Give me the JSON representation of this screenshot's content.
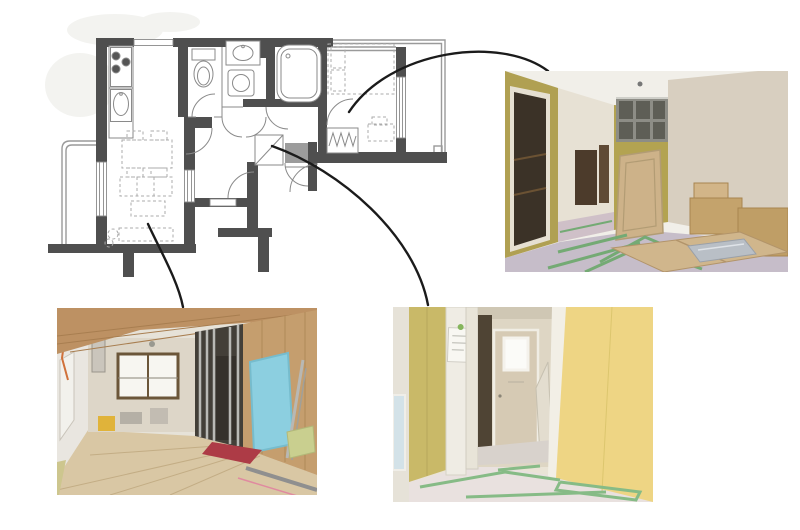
{
  "canvas": {
    "width": 800,
    "height": 530,
    "background": "#ffffff"
  },
  "composite": {
    "description": "apartment floor plan linked by curved arrows to three renovation site photos"
  },
  "floor_plan": {
    "colors": {
      "wall": "#4f4f4f",
      "fixture": "#8a8a8a",
      "furniture": "#ababab",
      "genkan": "#9c9c9c",
      "balcony": "#9a9a9a",
      "watermark": "#f3f3f0",
      "burner": "#555555"
    },
    "rooms": [
      "living-dining",
      "kitchen",
      "toilet",
      "washroom",
      "bathroom",
      "bedroom",
      "hallway",
      "entrance",
      "walk-in-closet",
      "balcony-left",
      "balcony-right"
    ],
    "fixtures": [
      "gas-stove",
      "kitchen-sink",
      "toilet-bowl",
      "washbasin",
      "washing-machine",
      "bathtub",
      "double-bed",
      "desk",
      "hanger-pipe-closet",
      "dining-table",
      "sofa",
      "coffee-table",
      "tv-board",
      "shoe-cabinet"
    ]
  },
  "connectors": {
    "color": "#1b1b1b",
    "width": 2.4,
    "items": [
      {
        "name": "bedroom-to-photo-top-right"
      },
      {
        "name": "living-to-photo-bottom-left"
      },
      {
        "name": "hallway-to-photo-bottom-center"
      }
    ]
  },
  "photos": [
    {
      "name": "photo-top-right",
      "depicts": "room under renovation with yellow plasterboard walls, cardboard boxes and green-taped floor protection",
      "palette": {
        "ceiling": "#f1efe9",
        "left_wall": "#b0a052",
        "door_frame": "#e6e0d2",
        "door_interior": "#3b3227",
        "corridor_wall": "#e7e1d4",
        "corridor_floor": "#cfc0c8",
        "grid_frame": "#8d8d86",
        "grid_cell": "#5e5e56",
        "center_wall": "#b3a351",
        "right_wall": "#d8cfc0",
        "panel": "#cdb289",
        "box": "#c4a36c",
        "box_light": "#d2b588",
        "box_dark": "#bf9e66",
        "box_top": "#d0b68c",
        "floor": "#c6bdc9",
        "tape": "#74aa74",
        "booklet": "#b9bfc6"
      }
    },
    {
      "name": "photo-bottom-left",
      "depicts": "living-dining room under renovation with plywood subfloor, metal stud partition and blue foam panel",
      "palette": {
        "ceiling": "#bd9163",
        "back_wall": "#ddd6c8",
        "left_wall": "#e9e6e0",
        "window": "#f7f6f1",
        "window_frame": "#6b5639",
        "stud_wall": "#433f38",
        "stud_metal": "#b9b9b5",
        "right_wall": "#c59e6e",
        "blue_panel": "#8ccfe0",
        "floor": "#d9c7a4",
        "red_mat": "#ad3b46",
        "bucket": "#e0b33a",
        "green_board": "#c9cf8f",
        "duct": "#cac5bc",
        "tatami": "#cdc68e"
      }
    },
    {
      "name": "photo-bottom-center",
      "depicts": "hallway under renovation with yellow walls, white frames and green-taped floor",
      "palette": {
        "left_sliver": "#e6e2d8",
        "left_window": "#d3e2e8",
        "left_wall": "#c9b968",
        "post": "#efece4",
        "paper": "#f8f7f2",
        "corridor_wall": "#ded6c4",
        "dark_opening": "#4f4434",
        "door": "#d6cab4",
        "door_window": "#fbfbf8",
        "boards": "#e3ddcf",
        "right_wall": "#eed584",
        "right_frame": "#f2efe6",
        "floor": "#e9e1df",
        "corridor_floor": "#d8d2cc",
        "tape": "#86bb86",
        "lintel": "#cfc7b4"
      }
    }
  ]
}
